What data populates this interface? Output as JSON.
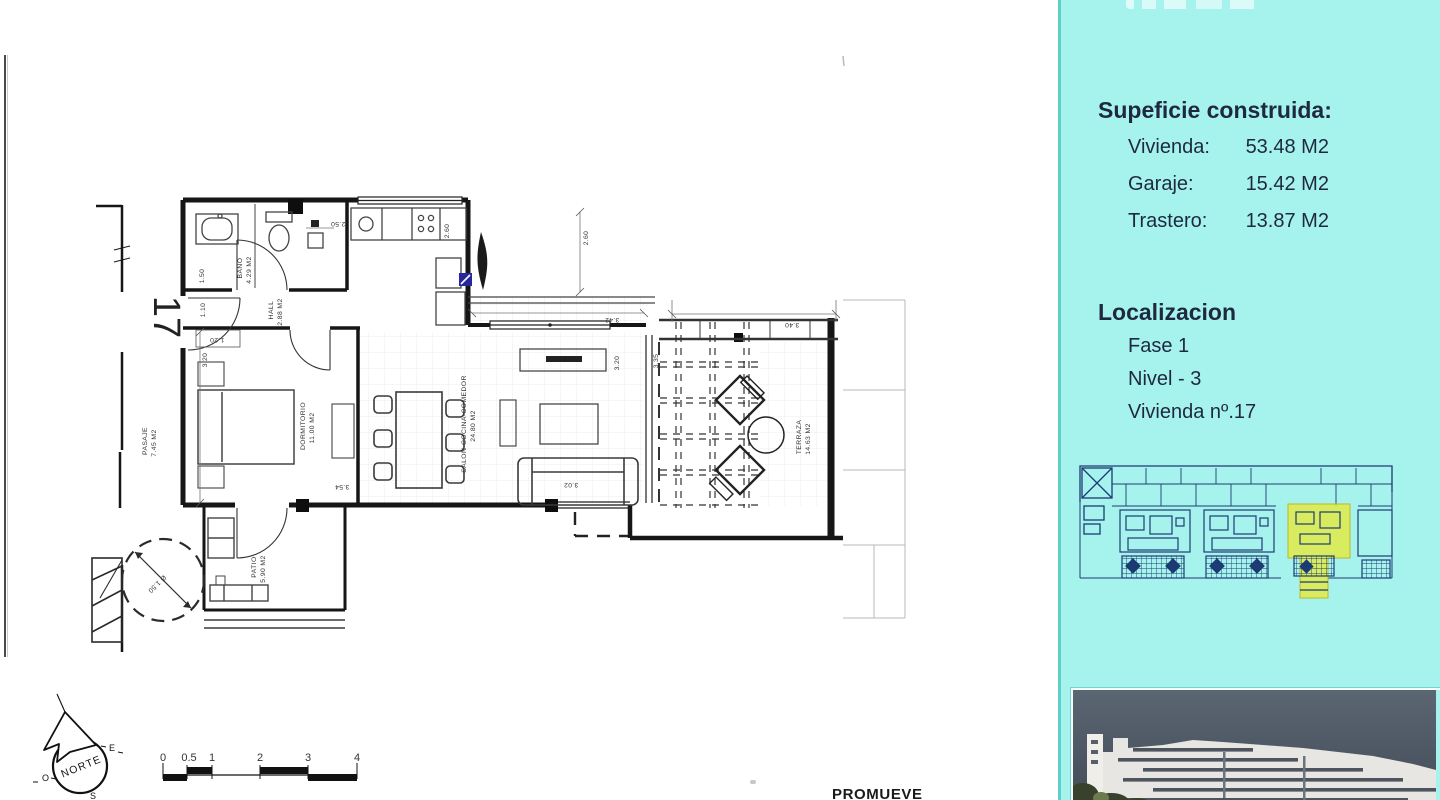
{
  "sidebar": {
    "surface": {
      "title": "Supeficie construida:",
      "rows": [
        {
          "label": "Vivienda:",
          "value": "53.48 M2"
        },
        {
          "label": "Garaje:",
          "value": "15.42 M2"
        },
        {
          "label": "Trastero:",
          "value": "13.87 M2"
        }
      ]
    },
    "location": {
      "title": "Localizacion",
      "rows": [
        "Fase 1",
        "Nivel - 3",
        "Vivienda nº.17"
      ]
    }
  },
  "plan": {
    "unit_number": "17",
    "rooms": [
      {
        "name": "BAÑO",
        "area": "4.29 M2"
      },
      {
        "name": "HALL",
        "area": "2.88 M2"
      },
      {
        "name": "DORMITORIO",
        "area": "11.00 M2"
      },
      {
        "name": "SALON-COCINA-COMEDOR",
        "area": "24.80 M2"
      },
      {
        "name": "TERRAZA",
        "area": "14.63 M2"
      },
      {
        "name": "PASAJE",
        "area": "7.45 M2"
      },
      {
        "name": "PATIO",
        "area": "5.90 M2"
      }
    ],
    "dims": [
      "2.50",
      "2.60",
      "2.60",
      "1.50",
      "1.20",
      "1.10",
      "3.20",
      "3.54",
      "3.02",
      "3.20",
      "3.35",
      "3.42",
      "3.40",
      "Ø 1.50"
    ]
  },
  "compass": {
    "north": "NORTE",
    "east": "E",
    "west": "O",
    "south": "S"
  },
  "scalebar": {
    "ticks": [
      "0",
      "0.5",
      "1",
      "2",
      "3",
      "4"
    ]
  },
  "footer": {
    "promoter_label": "PROMUEVE"
  }
}
